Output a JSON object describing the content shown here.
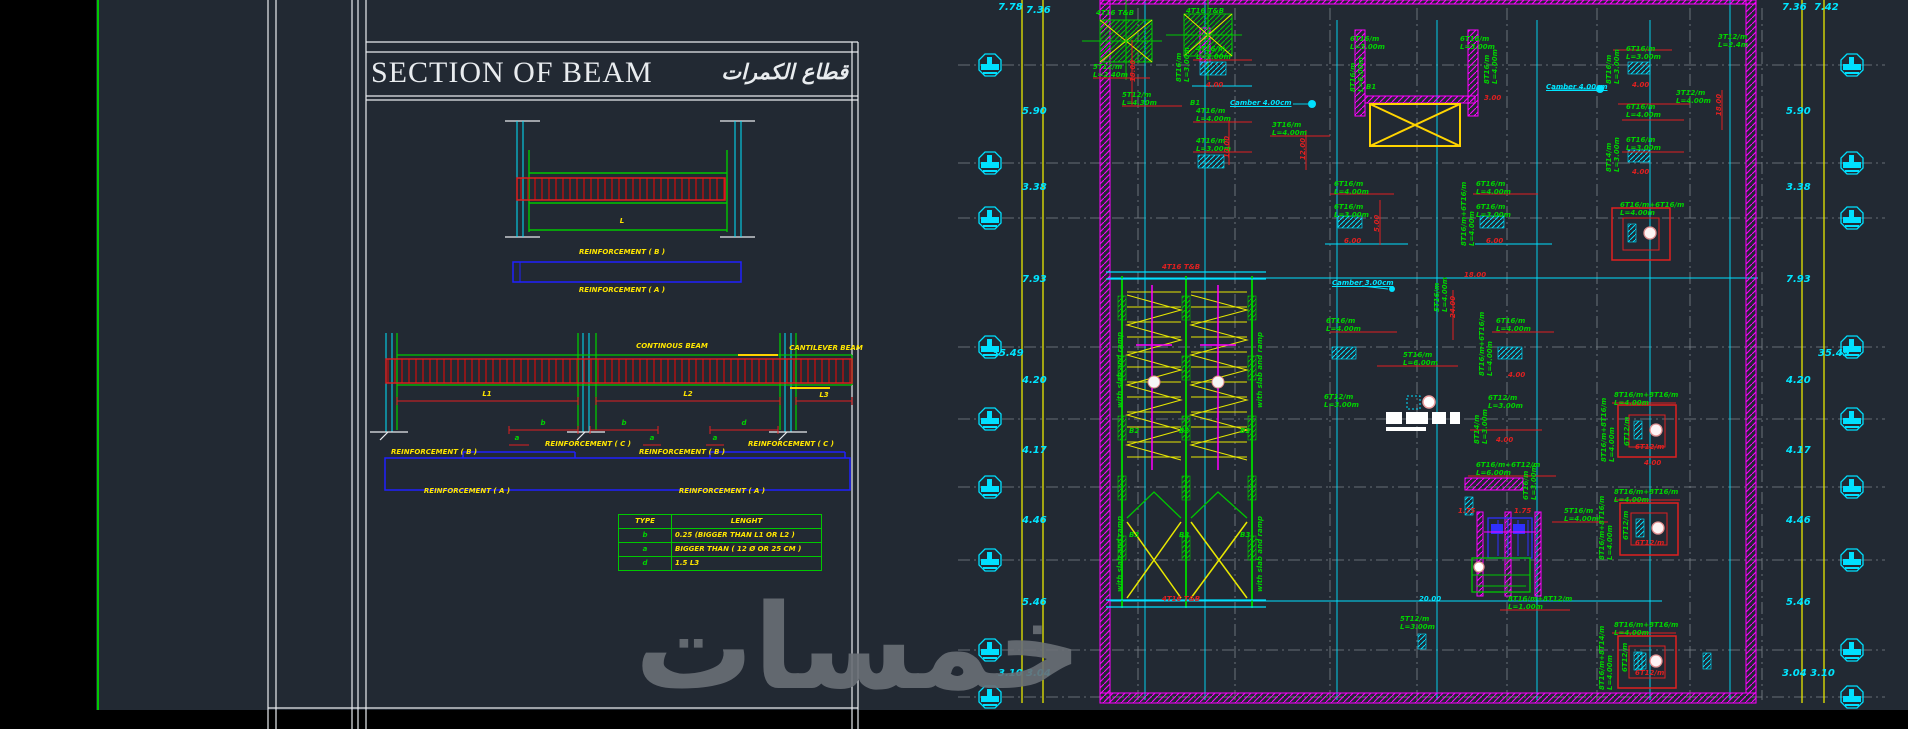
{
  "colors": {
    "green": "#00d400",
    "red": "#e02020",
    "cyan": "#00e5ff",
    "yellow": "#ffe600",
    "magenta": "#ff00ff",
    "background": "#222933",
    "white_line": "#e9ecef"
  },
  "watermark": "خمسات",
  "section": {
    "title": "SECTION OF BEAM",
    "title_ar": "قطاع الكمرات",
    "labels": [
      {
        "t": "L",
        "x": 622,
        "y": 218,
        "c": "y"
      },
      {
        "t": "REINFORCEMENT ( B )",
        "x": 622,
        "y": 249,
        "c": "y"
      },
      {
        "t": "REINFORCEMENT ( A )",
        "x": 622,
        "y": 287,
        "c": "y"
      },
      {
        "t": "CONTINOUS BEAM",
        "x": 672,
        "y": 343,
        "c": "y"
      },
      {
        "t": "CANTILEVER BEAM",
        "x": 826,
        "y": 345,
        "c": "y"
      },
      {
        "t": "L1",
        "x": 487,
        "y": 391,
        "c": "y"
      },
      {
        "t": "L2",
        "x": 688,
        "y": 391,
        "c": "y"
      },
      {
        "t": "L3",
        "x": 824,
        "y": 392,
        "c": "y"
      },
      {
        "t": "b",
        "x": 543,
        "y": 420,
        "c": "g"
      },
      {
        "t": "b",
        "x": 624,
        "y": 420,
        "c": "g"
      },
      {
        "t": "d",
        "x": 744,
        "y": 420,
        "c": "g"
      },
      {
        "t": "a",
        "x": 517,
        "y": 435,
        "c": "g"
      },
      {
        "t": "a",
        "x": 652,
        "y": 435,
        "c": "g"
      },
      {
        "t": "a",
        "x": 715,
        "y": 435,
        "c": "g"
      },
      {
        "t": "REINFORCEMENT ( B )",
        "x": 434,
        "y": 449,
        "c": "y"
      },
      {
        "t": "REINFORCEMENT ( C )",
        "x": 588,
        "y": 441,
        "c": "y"
      },
      {
        "t": "REINFORCEMENT ( B )",
        "x": 682,
        "y": 449,
        "c": "y"
      },
      {
        "t": "REINFORCEMENT ( C )",
        "x": 791,
        "y": 441,
        "c": "y"
      },
      {
        "t": "REINFORCEMENT ( A )",
        "x": 467,
        "y": 488,
        "c": "y"
      },
      {
        "t": "REINFORCEMENT ( A )",
        "x": 722,
        "y": 488,
        "c": "y"
      }
    ],
    "table": {
      "headers": [
        "TYPE",
        "LENGHT"
      ],
      "rows": [
        [
          "b",
          "0.25 (BIGGER THAN L1 OR L2 )"
        ],
        [
          "a",
          "BIGGER THAN ( 12 Ø OR 25 CM )"
        ],
        [
          "d",
          "1.5 L3"
        ]
      ]
    }
  },
  "plan": {
    "marker_rows": [
      65,
      163,
      218,
      347,
      419,
      487,
      560,
      650,
      697
    ],
    "labels": [
      {
        "t": "4T16 T&B",
        "x": 196,
        "y": 10
      },
      {
        "t": "4T16 T&B",
        "x": 286,
        "y": 8
      },
      {
        "t": "5T12/m\nL=2.40m",
        "x": 193,
        "y": 64
      },
      {
        "t": "5T12/m\nL=4.30m",
        "x": 222,
        "y": 92
      },
      {
        "t": "8T16/m\nL=3.00m",
        "x": 276,
        "y": 82,
        "r": 1
      },
      {
        "t": "4T16/m\nL=3.00m",
        "x": 296,
        "y": 46
      },
      {
        "t": "4.00",
        "x": 306,
        "y": 82,
        "c": "r"
      },
      {
        "t": "18.00",
        "x": 230,
        "y": 82,
        "r": 1,
        "c": "r"
      },
      {
        "t": "B1",
        "x": 290,
        "y": 100
      },
      {
        "t": "Camber 4.00cm",
        "x": 330,
        "y": 100,
        "c": "c",
        "u": 1
      },
      {
        "t": "4T16/m\nL=4.00m",
        "x": 296,
        "y": 108
      },
      {
        "t": "4T16/m\nL=3.00m",
        "x": 296,
        "y": 138
      },
      {
        "t": "10.00",
        "x": 324,
        "y": 158,
        "r": 1,
        "c": "r"
      },
      {
        "t": "3T16/m\nL=4.00m",
        "x": 372,
        "y": 122
      },
      {
        "t": "12.00",
        "x": 400,
        "y": 160,
        "r": 1,
        "c": "r"
      },
      {
        "t": "6T16/m\nL=3.00m",
        "x": 450,
        "y": 36
      },
      {
        "t": "8T16/m\nL=6.00m",
        "x": 450,
        "y": 92,
        "r": 1
      },
      {
        "t": "B1",
        "x": 466,
        "y": 84
      },
      {
        "t": "6T16/m\nL=3.00m",
        "x": 560,
        "y": 36
      },
      {
        "t": "8T16/m\nL=4.00m",
        "x": 584,
        "y": 84,
        "r": 1
      },
      {
        "t": "3.00",
        "x": 584,
        "y": 95,
        "c": "r"
      },
      {
        "t": "Camber 4.00cm",
        "x": 646,
        "y": 84,
        "c": "c",
        "u": 1
      },
      {
        "t": "8T16/m\nL=3.00m",
        "x": 706,
        "y": 84,
        "r": 1
      },
      {
        "t": "6T16/m\nL=3.00m",
        "x": 726,
        "y": 46
      },
      {
        "t": "4.00",
        "x": 732,
        "y": 82,
        "c": "r"
      },
      {
        "t": "3T12/m\nL=2.4m",
        "x": 818,
        "y": 34
      },
      {
        "t": "3T12/m\nL=4.00m",
        "x": 776,
        "y": 90
      },
      {
        "t": "18.00",
        "x": 816,
        "y": 116,
        "r": 1,
        "c": "r"
      },
      {
        "t": "6T16/m\nL=4.00m",
        "x": 726,
        "y": 104
      },
      {
        "t": "8T14/m\nL=3.00m",
        "x": 706,
        "y": 172,
        "r": 1
      },
      {
        "t": "6T16/m\nL=3.00m",
        "x": 726,
        "y": 137
      },
      {
        "t": "4.00",
        "x": 732,
        "y": 169,
        "c": "r"
      },
      {
        "t": "6T16/m\nL=4.00m",
        "x": 434,
        "y": 181
      },
      {
        "t": "6T16/m\nL=3.00m",
        "x": 434,
        "y": 204
      },
      {
        "t": "6.00",
        "x": 444,
        "y": 238,
        "c": "r"
      },
      {
        "t": "5.00",
        "x": 474,
        "y": 232,
        "r": 1,
        "c": "r"
      },
      {
        "t": "6T16/m\nL=4.00m",
        "x": 576,
        "y": 181
      },
      {
        "t": "6T16/m\nL=3.00m",
        "x": 576,
        "y": 204
      },
      {
        "t": "8T16/m+6T16/m\nL=4.00m",
        "x": 561,
        "y": 246,
        "r": 1
      },
      {
        "t": "6.00",
        "x": 586,
        "y": 238,
        "c": "r"
      },
      {
        "t": "18.00",
        "x": 564,
        "y": 272,
        "c": "r"
      },
      {
        "t": "6T16/m+6T16/m\nL=4.00m",
        "x": 720,
        "y": 202
      },
      {
        "t": "Camber 3.00cm",
        "x": 432,
        "y": 280,
        "c": "c",
        "u": 1
      },
      {
        "t": "5T16/m\nL=4.00m",
        "x": 534,
        "y": 312,
        "r": 1
      },
      {
        "t": "24.00",
        "x": 550,
        "y": 318,
        "r": 1,
        "c": "r"
      },
      {
        "t": "6T16/m\nL=4.00m",
        "x": 426,
        "y": 318
      },
      {
        "t": "6T16/m\nL=4.00m",
        "x": 596,
        "y": 318
      },
      {
        "t": "8T16/m+6T16/m\nL=4.00m",
        "x": 579,
        "y": 376,
        "r": 1
      },
      {
        "t": "5T16/m\nL=6.00m",
        "x": 503,
        "y": 352
      },
      {
        "t": "4.00",
        "x": 608,
        "y": 372,
        "c": "r"
      },
      {
        "t": "6T12/m\nL=3.00m",
        "x": 424,
        "y": 394
      },
      {
        "t": "6T12/m\nL=3.00m",
        "x": 588,
        "y": 395
      },
      {
        "t": "8T14/m\nL=3.00m",
        "x": 574,
        "y": 444,
        "r": 1
      },
      {
        "t": "4.00",
        "x": 596,
        "y": 437,
        "c": "r"
      },
      {
        "t": "8T16/m+8T16/m\nL=4.00m",
        "x": 714,
        "y": 392
      },
      {
        "t": "8T16/m+8T16/m\nL=4.00m",
        "x": 701,
        "y": 462,
        "r": 1
      },
      {
        "t": "6T12/m",
        "x": 724,
        "y": 446,
        "r": 1
      },
      {
        "t": "6T12/m",
        "x": 735,
        "y": 444,
        "c": "r"
      },
      {
        "t": "4.00",
        "x": 744,
        "y": 460,
        "c": "r"
      },
      {
        "t": "6T16/m+6T12/m\nL=6.00m",
        "x": 576,
        "y": 462
      },
      {
        "t": "1.75",
        "x": 558,
        "y": 508,
        "c": "r"
      },
      {
        "t": "1.75",
        "x": 614,
        "y": 508,
        "c": "r"
      },
      {
        "t": "6T16/m\nL=3.00m",
        "x": 623,
        "y": 500,
        "r": 1
      },
      {
        "t": "5T16/m\nL=4.00m",
        "x": 664,
        "y": 508
      },
      {
        "t": "8T16/m+8T16/m\nL=4.00m",
        "x": 714,
        "y": 489
      },
      {
        "t": "8T16/m+8T16/m\nL=4.00m",
        "x": 699,
        "y": 560,
        "r": 1
      },
      {
        "t": "6T12/m",
        "x": 723,
        "y": 540,
        "r": 1
      },
      {
        "t": "6T12/m",
        "x": 735,
        "y": 540,
        "c": "r"
      },
      {
        "t": "20.00",
        "x": 519,
        "y": 596,
        "c": "c"
      },
      {
        "t": "5T12/m\nL=3.00m",
        "x": 500,
        "y": 616
      },
      {
        "t": "8T16/m+8T12/m\nL=1.00m",
        "x": 608,
        "y": 596
      },
      {
        "t": "8T16/m+8T14/m\nL=4.00m",
        "x": 699,
        "y": 690,
        "r": 1
      },
      {
        "t": "8T16/m+8T16/m\nL=4.00m",
        "x": 714,
        "y": 622
      },
      {
        "t": "6T12/m",
        "x": 722,
        "y": 672,
        "r": 1
      },
      {
        "t": "6T12/m",
        "x": 735,
        "y": 670,
        "c": "r"
      },
      {
        "t": "4T16 T&B",
        "x": 262,
        "y": 264,
        "c": "r"
      },
      {
        "t": "4T16 T&B",
        "x": 262,
        "y": 596,
        "c": "r"
      },
      {
        "t": "B2",
        "x": 229,
        "y": 428
      },
      {
        "t": "B2",
        "x": 279,
        "y": 428
      },
      {
        "t": "B2",
        "x": 340,
        "y": 428
      },
      {
        "t": "B3",
        "x": 229,
        "y": 532
      },
      {
        "t": "B3",
        "x": 279,
        "y": 532
      },
      {
        "t": "B3",
        "x": 340,
        "y": 532
      },
      {
        "t": "with slab and ramp",
        "x": 217,
        "y": 408,
        "r": 1
      },
      {
        "t": "with slab and ramp",
        "x": 357,
        "y": 408,
        "r": 1
      },
      {
        "t": "with slab and ramp",
        "x": 217,
        "y": 592,
        "r": 1
      },
      {
        "t": "with slab and ramp",
        "x": 357,
        "y": 592,
        "r": 1
      },
      {
        "t": "7.78",
        "x": 98,
        "y": 2,
        "c": "c",
        "fs": 10
      },
      {
        "t": "7.36",
        "x": 126,
        "y": 5,
        "c": "c",
        "fs": 10
      },
      {
        "t": "5.90",
        "x": 122,
        "y": 106,
        "c": "c",
        "fs": 10
      },
      {
        "t": "3.38",
        "x": 122,
        "y": 182,
        "c": "c",
        "fs": 10
      },
      {
        "t": "7.93",
        "x": 122,
        "y": 274,
        "c": "c",
        "fs": 10
      },
      {
        "t": "35.49",
        "x": 92,
        "y": 348,
        "c": "c",
        "fs": 10
      },
      {
        "t": "4.20",
        "x": 122,
        "y": 375,
        "c": "c",
        "fs": 10
      },
      {
        "t": "4.17",
        "x": 122,
        "y": 445,
        "c": "c",
        "fs": 10
      },
      {
        "t": "4.46",
        "x": 122,
        "y": 515,
        "c": "c",
        "fs": 10
      },
      {
        "t": "5.46",
        "x": 122,
        "y": 597,
        "c": "c",
        "fs": 10
      },
      {
        "t": "3.10 3.04",
        "x": 98,
        "y": 668,
        "c": "c",
        "fs": 10
      },
      {
        "t": "7.36",
        "x": 882,
        "y": 2,
        "c": "c",
        "fs": 10
      },
      {
        "t": "7.42",
        "x": 914,
        "y": 2,
        "c": "c",
        "fs": 10
      },
      {
        "t": "5.90",
        "x": 886,
        "y": 106,
        "c": "c",
        "fs": 10
      },
      {
        "t": "3.38",
        "x": 886,
        "y": 182,
        "c": "c",
        "fs": 10
      },
      {
        "t": "7.93",
        "x": 886,
        "y": 274,
        "c": "c",
        "fs": 10
      },
      {
        "t": "35.49",
        "x": 918,
        "y": 348,
        "c": "c",
        "fs": 10
      },
      {
        "t": "4.20",
        "x": 886,
        "y": 375,
        "c": "c",
        "fs": 10
      },
      {
        "t": "4.17",
        "x": 886,
        "y": 445,
        "c": "c",
        "fs": 10
      },
      {
        "t": "4.46",
        "x": 886,
        "y": 515,
        "c": "c",
        "fs": 10
      },
      {
        "t": "5.46",
        "x": 886,
        "y": 597,
        "c": "c",
        "fs": 10
      },
      {
        "t": "3.04 3.10",
        "x": 882,
        "y": 668,
        "c": "c",
        "fs": 10
      }
    ]
  }
}
